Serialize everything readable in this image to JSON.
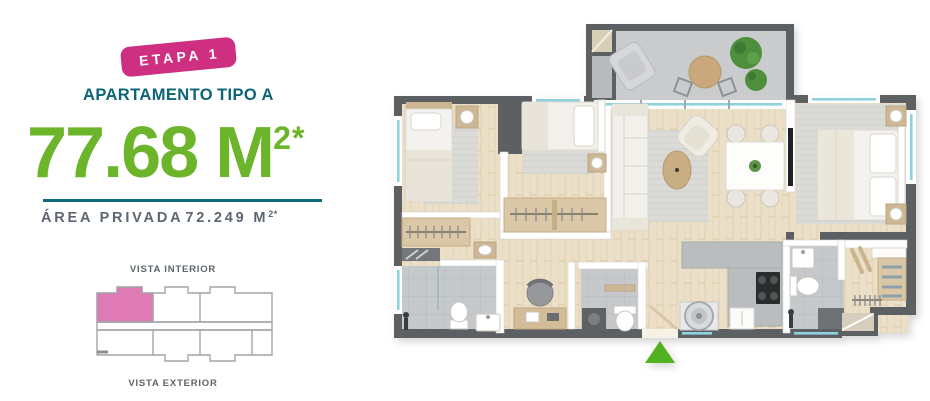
{
  "panel": {
    "badge": "ETAPA 1",
    "title_main": "APARTAMENTO",
    "title_type": "TIPO A",
    "area_value": "77.68 M",
    "area_sup": "2*",
    "private_area_label": "ÁREA PRIVADA",
    "private_area_value": "72.249 M",
    "private_area_sup": "2*"
  },
  "keyplan": {
    "label_top": "VISTA INTERIOR",
    "label_bottom": "VISTA EXTERIOR"
  },
  "colors": {
    "badge-pink": "#ce2f80",
    "title-teal": "#0e6476",
    "area-green": "#6cb52b",
    "divider-teal": "#0f6a7c",
    "text-gray": "#5b6670",
    "label-gray": "#5d6468",
    "keyplan-pink": "#de7ab4",
    "keyplan-outline": "#a2a6a9",
    "marker-green": "#52b11e"
  }
}
